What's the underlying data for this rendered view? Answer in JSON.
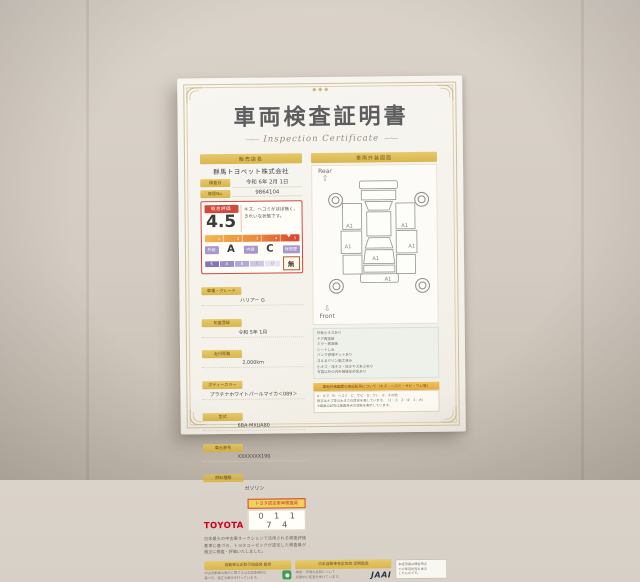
{
  "colors": {
    "accent_red": "#d3473d",
    "label_yellow": "#ddbb55",
    "toyota_red": "#d0021b",
    "scale_purple": "#8677b3",
    "gauge_orange": "#ea8a3e"
  },
  "certificate": {
    "title": "車両検査証明書",
    "subtitle": "Inspection Certificate",
    "dash": "—·—",
    "dealer": {
      "header": "販売店名",
      "name": "群馬トヨペット株式会社"
    },
    "issue": {
      "date_label": "検査日",
      "date_value": "令和 6年 2月 1日",
      "no_label": "管理No.",
      "no_value": "9864104"
    },
    "evaluation": {
      "label": "総合評価",
      "score": "4.5",
      "comment_line1": "キズ、ヘコミがほぼ無く、",
      "comment_line2": "きれいな状態です。",
      "scale_ticks": [
        "1",
        "2",
        "3",
        "4",
        "5"
      ]
    },
    "ratings": {
      "exterior_label": "外装",
      "exterior_value": "A",
      "interior_label": "内装",
      "interior_value": "C",
      "repair_label": "修復歴",
      "repair_value": "無",
      "scale_letters": [
        "S",
        "A",
        "B",
        "C",
        "D"
      ]
    },
    "specs": [
      {
        "label": "車種・グレード",
        "value": "ハリアー G"
      },
      {
        "label": "初度登録",
        "value": "令和 5年 1月"
      },
      {
        "label": "走行距離",
        "value": "2,000km"
      },
      {
        "label": "ボディーカラー",
        "value": "プラチナホワイトパールマイカ＜089＞"
      },
      {
        "label": "型式",
        "value": "6BA-MXUA80"
      },
      {
        "label": "車台番号",
        "value": "XXXXXXX190"
      },
      {
        "label": "燃料種類",
        "value": "ガソリン"
      }
    ],
    "inspector": {
      "brand": "TOYOTA",
      "badge": "トヨタ認定車両検査員",
      "number": "0 1 1 7 4"
    },
    "statement": "日本最大の中古車オークションで活用される検査評価基準に基づき、トヨタユーゼックが認定した検査員が厳正に検査・評価いたしました。",
    "diagram": {
      "header": "車両外装図面",
      "rear_label": "Rear",
      "front_label": "Front",
      "rear_arrow": "⇧",
      "front_arrow": "⇩",
      "markers": [
        "A1",
        "A1",
        "A1",
        "A1",
        "A1",
        "A1"
      ]
    },
    "notes": [
      "外板小キズあり",
      "ドア再塗装",
      "ミラー再塗装",
      "シートしみ",
      "パンク修理キットあり",
      "きえるクリン施工済み",
      "小キズ・浅キズ・拭きキズ多少あり",
      "写真以外の内外装経年劣化あり"
    ],
    "legend": {
      "header": "車両外装図面の表記記号について（キズ・ヘコミ・サビ・ワレ等）",
      "line1": "A：キズ　B：ヘコミ　C：サビ　D：ワレ　E：その他",
      "line2": "数字はキズ等の大きさの目安を表しています。（1：小　2：中　3：大）",
      "line3": "※図面の記号は検査時点の状態を表示しています。"
    },
    "footer": {
      "fair_trade": {
        "header": "自動車公正取引協議会 監修",
        "line1": "中古自動車の表示に関する公正競争規約に",
        "line2": "基づき、適正な表示を行っています。"
      },
      "jaai": {
        "header": "日本自動車査定協会 定期監査",
        "line1": "検査・評価の品質について",
        "line2": "定期的に監査を受けています。",
        "logo": "JAAI"
      },
      "notice": {
        "line1": "本証明書は検査時点",
        "line2": "での車両状態を表示",
        "line3": "したものです。"
      }
    }
  }
}
